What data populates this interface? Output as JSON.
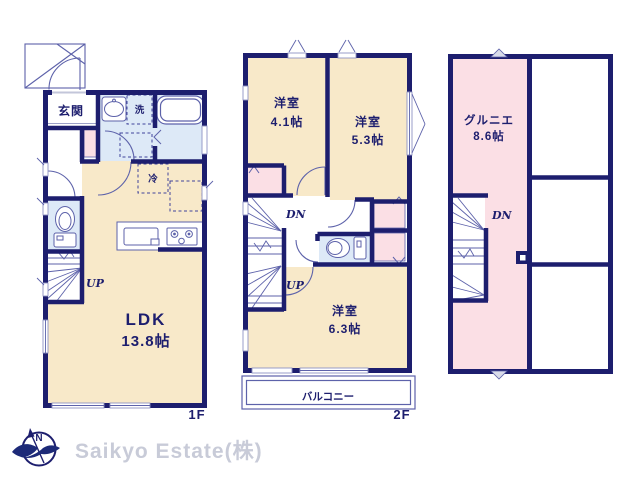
{
  "document": {
    "type": "real-estate-floor-plan"
  },
  "colors": {
    "wall": "#1d1e6e",
    "thin_line": "#5d62aa",
    "room_beige": "#f8e9c9",
    "room_pink": "#fbdfe5",
    "room_blue": "#dde9f7",
    "footer_text": "#c8cbd8"
  },
  "floor1": {
    "floor_label": "1F",
    "entrance_label": "玄関",
    "laundry_label": "洗",
    "fridge_label": "冷",
    "ldk_name": "LDK",
    "ldk_size": "13.8帖",
    "stairs_up_label": "UP"
  },
  "floor2": {
    "floor_label": "2F",
    "room1_name": "洋室",
    "room1_size": "4.1帖",
    "room2_name": "洋室",
    "room2_size": "5.3帖",
    "room3_name": "洋室",
    "room3_size": "6.3帖",
    "stairs_down_label": "DN",
    "stairs_up_label": "UP",
    "balcony_label": "バルコニー"
  },
  "attic": {
    "room_name": "グルニエ",
    "room_size": "8.6帖",
    "stairs_down_label": "DN"
  },
  "footer": {
    "compass_n": "N",
    "company": "Saikyo Estate(株)"
  }
}
